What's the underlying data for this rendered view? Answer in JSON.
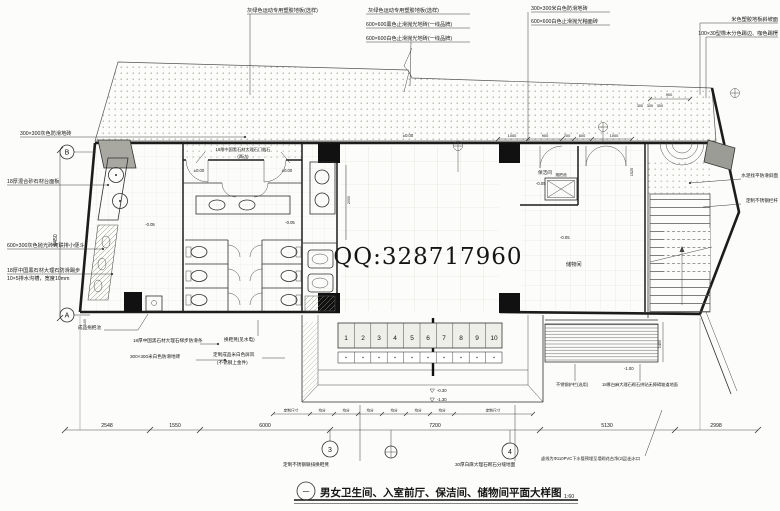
{
  "watermark": "QQ:328717960",
  "title": {
    "index": "一",
    "text": "男女卫生间、入室前厅、保洁间、储物间平面大样图",
    "scale": "1:60"
  },
  "rooms": {
    "cleaning": "保洁间",
    "storage": "储物间",
    "mop": "拖把池"
  },
  "axes": {
    "a": "A",
    "b": "B",
    "n3": "3",
    "n4": "4"
  },
  "ann": {
    "top1": "灰绿色运动专用塑胶地板(选样)",
    "top2": "灰绿色运动专用塑胶地板(选样)",
    "top3": "600×600黑色止滑抛光地砖(一线品牌)",
    "top4": "600×600白色止滑抛光地砖(一线品牌)",
    "top5": "300×300米白色防滑地砖",
    "top6": "600×600白色止滑抛光釉面砖",
    "top7": "米色塑胶地板斜坡面",
    "top8": "100×30型橡木分色踢边、咖色踢楞",
    "left1": "300×300灰色防滑地砖",
    "left2": "18厚混合砂石材台面板",
    "left3": "600×300灰色抛光砖砌联排小便斗",
    "left4": "18厚中国黑石材大理石防滑踢步",
    "left5": "10×5排水沟槽，宽度10mm",
    "left6": "成品拖把池",
    "left7": "18厚中国黑石材大理石梯步防滑条",
    "left8": "300×300米白色防滑地砖",
    "mid1": "换鞋凳(见水电)",
    "mid2": "定制成品米白色屏风",
    "mid3": "(不锈钢上金件)",
    "sill1": "18厚中国黑石材大理石门槛石",
    "sill2": "(两边)",
    "bot1": "定制不锈钢联排换鞋凳",
    "bot2": "30厚白麻大理石砌石分缝地面",
    "bot3": "虚线为Φ110PVC下水管预埋至墙砌花台净(2层)出水口",
    "right1": "水泥找平防滑斜面",
    "right2": "定制不锈钢栏杆",
    "right3": "不锈钢护栏(选用)",
    "right4": "18厚白麻大理石砌石拼贴无障碍坡道地面"
  },
  "dims": {
    "bottom": [
      "2548",
      "1550",
      "6000",
      "7200",
      "5130",
      "2998"
    ],
    "left_v": "6450",
    "d100": "100",
    "d2000": "2000",
    "d1525": "1525",
    "d1400": "1400",
    "d900": "900",
    "d300a": "300",
    "d300b": "300",
    "d300c": "300",
    "foyer": [
      "1000",
      "900",
      "200",
      "600",
      "1000"
    ],
    "locker_row": [
      "定制尺寸",
      "均分",
      "均分",
      "均分",
      "均分",
      "均分",
      "均分",
      "定制尺寸"
    ]
  },
  "elev": {
    "e1": "±0.00",
    "e2": "-0.05",
    "e3": "-0.05",
    "e4": "-0.05",
    "e5": "-0.05",
    "e6": "-0.30",
    "e7": "-1.30",
    "e8": "-1.00"
  },
  "lockers": [
    "1",
    "2",
    "3",
    "4",
    "5",
    "6",
    "7",
    "8",
    "9",
    "10"
  ]
}
